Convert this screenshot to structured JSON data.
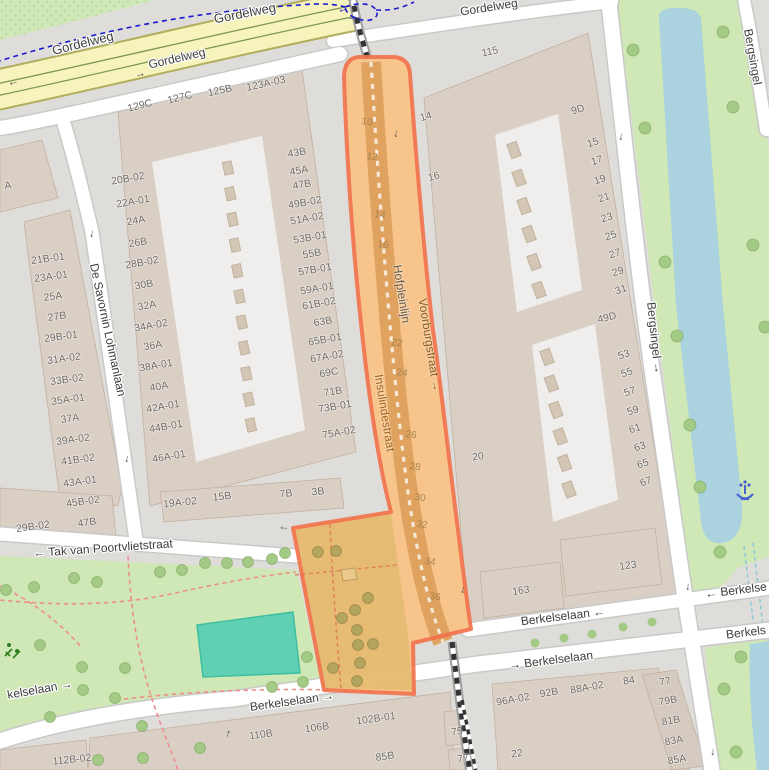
{
  "map": {
    "colors": {
      "bg": "#dfddd9",
      "park": "#cfe8b6",
      "water": "#aad3df",
      "pitch": "#5fd0b4",
      "pitch_stroke": "#3fbf9e",
      "bldg": "#d9cfc5",
      "bldg_stroke": "#c3b1a0",
      "courtyard": "#efeeec",
      "unit": "#d3c6b5",
      "unit_stroke": "#bcab96",
      "road_fill": "#ffffff",
      "road_casing": "#c9c9c9",
      "yellow": "#f6f3bc",
      "yellow_casing": "#b2ae5e",
      "tram": "#7d9a4f",
      "rail_grey": "#9e9e9e",
      "cycle": "#1a1ad0",
      "sel_fill": "#f8c288",
      "sel_stroke": "#f1714b",
      "sel_rail": "#dfa35f",
      "sel_park": "#e3bb72",
      "sel_tree": "#b2a55e",
      "sel_path": "#e07858",
      "tree": "#a4cb86",
      "path_pink": "#ef8f8f",
      "street_text": "#3d3d3d",
      "hnum": "#6f6a63",
      "rnum": "#9c7c47",
      "railname": "#6d6051",
      "selname": "#8a5c22",
      "insul": "#a2681f",
      "fountain": "#4a63d3",
      "playground": "#2f7d1f",
      "dots": "#b9d3a4"
    },
    "street_labels": [
      {
        "t": "Gordelweg",
        "x": 83,
        "y": 44,
        "r": -14,
        "cls": "big"
      },
      {
        "t": "Gordelweg",
        "x": 245,
        "y": 14,
        "r": -11,
        "cls": "big"
      },
      {
        "t": "Gordelweg",
        "x": 177,
        "y": 59,
        "r": -13
      },
      {
        "t": "Gordelweg",
        "x": 489,
        "y": 8,
        "r": -9
      },
      {
        "t": "De Savornin Lohmanlaan",
        "x": 107,
        "y": 330,
        "r": 78
      },
      {
        "t": "← Tak van Poortvlietstraat",
        "x": 103,
        "y": 549,
        "r": -4
      },
      {
        "t": "Berkelselaan ←",
        "x": 563,
        "y": 617,
        "r": -7
      },
      {
        "t": "→ Berkelselaan",
        "x": 551,
        "y": 661,
        "r": -7
      },
      {
        "t": "← Berkelse",
        "x": 736,
        "y": 591,
        "r": -7
      },
      {
        "t": "Berkels",
        "x": 746,
        "y": 633,
        "r": -7
      },
      {
        "t": "kelselaan →",
        "x": 40,
        "y": 690,
        "r": -10
      },
      {
        "t": "Berkelselaan →",
        "x": 292,
        "y": 702,
        "r": -8
      },
      {
        "t": "Bergsingel →",
        "x": 654,
        "y": 338,
        "r": 84
      },
      {
        "t": "Bergsingel",
        "x": 752,
        "y": 57,
        "r": 80
      },
      {
        "t": "Voorburgstraat →",
        "x": 429,
        "y": 345,
        "r": 81,
        "cls": "sel-name"
      },
      {
        "t": "Hofpleinlijn",
        "x": 401,
        "y": 294,
        "r": 81,
        "cls": "rail-name"
      },
      {
        "t": "Insulindestraat",
        "x": 384,
        "y": 413,
        "r": 81,
        "cls": "insul"
      }
    ],
    "house_numbers": [
      {
        "t": "A",
        "x": 8,
        "y": 186,
        "r": -8
      },
      {
        "t": "129C",
        "x": 140,
        "y": 106,
        "r": -14
      },
      {
        "t": "127C",
        "x": 180,
        "y": 98,
        "r": -14
      },
      {
        "t": "125B",
        "x": 220,
        "y": 91,
        "r": -12
      },
      {
        "t": "123A-03",
        "x": 266,
        "y": 84,
        "r": -12
      },
      {
        "t": "20B-02",
        "x": 128,
        "y": 179,
        "r": -10
      },
      {
        "t": "22A-01",
        "x": 133,
        "y": 202,
        "r": -10
      },
      {
        "t": "24A",
        "x": 136,
        "y": 221,
        "r": -10
      },
      {
        "t": "26B",
        "x": 138,
        "y": 243,
        "r": -10
      },
      {
        "t": "28B-02",
        "x": 142,
        "y": 263,
        "r": -10
      },
      {
        "t": "30B",
        "x": 144,
        "y": 285,
        "r": -10
      },
      {
        "t": "32A",
        "x": 147,
        "y": 306,
        "r": -10
      },
      {
        "t": "34A-02",
        "x": 151,
        "y": 326,
        "r": -10
      },
      {
        "t": "36A",
        "x": 153,
        "y": 346,
        "r": -10
      },
      {
        "t": "38A-01",
        "x": 156,
        "y": 366,
        "r": -10
      },
      {
        "t": "40A",
        "x": 159,
        "y": 387,
        "r": -10
      },
      {
        "t": "42A-01",
        "x": 163,
        "y": 407,
        "r": -10
      },
      {
        "t": "44B-01",
        "x": 166,
        "y": 427,
        "r": -10
      },
      {
        "t": "46A-01",
        "x": 169,
        "y": 457,
        "r": -10
      },
      {
        "t": "21B-01",
        "x": 48,
        "y": 259,
        "r": -8
      },
      {
        "t": "23A-01",
        "x": 51,
        "y": 277,
        "r": -8
      },
      {
        "t": "25A",
        "x": 53,
        "y": 297,
        "r": -8
      },
      {
        "t": "27B",
        "x": 57,
        "y": 317,
        "r": -8
      },
      {
        "t": "29B-01",
        "x": 61,
        "y": 337,
        "r": -8
      },
      {
        "t": "31A-02",
        "x": 64,
        "y": 359,
        "r": -8
      },
      {
        "t": "33B-02",
        "x": 67,
        "y": 380,
        "r": -8
      },
      {
        "t": "35A-01",
        "x": 68,
        "y": 400,
        "r": -8
      },
      {
        "t": "37A",
        "x": 70,
        "y": 419,
        "r": -8
      },
      {
        "t": "39A-02",
        "x": 73,
        "y": 440,
        "r": -8
      },
      {
        "t": "41B-02",
        "x": 78,
        "y": 460,
        "r": -8
      },
      {
        "t": "43A-01",
        "x": 80,
        "y": 482,
        "r": -8
      },
      {
        "t": "45B-02",
        "x": 83,
        "y": 502,
        "r": -8
      },
      {
        "t": "47B",
        "x": 87,
        "y": 523,
        "r": -8
      },
      {
        "t": "29B-02",
        "x": 33,
        "y": 527,
        "r": -8
      },
      {
        "t": "43B",
        "x": 297,
        "y": 153,
        "r": -10
      },
      {
        "t": "45A",
        "x": 299,
        "y": 171,
        "r": -10
      },
      {
        "t": "47B",
        "x": 302,
        "y": 185,
        "r": -10
      },
      {
        "t": "49B-02",
        "x": 305,
        "y": 203,
        "r": -10
      },
      {
        "t": "51A-02",
        "x": 307,
        "y": 219,
        "r": -10
      },
      {
        "t": "53B-01",
        "x": 310,
        "y": 238,
        "r": -10
      },
      {
        "t": "55B",
        "x": 312,
        "y": 254,
        "r": -10
      },
      {
        "t": "57B-01",
        "x": 315,
        "y": 270,
        "r": -10
      },
      {
        "t": "59A-01",
        "x": 317,
        "y": 289,
        "r": -10
      },
      {
        "t": "61B-02",
        "x": 319,
        "y": 304,
        "r": -10
      },
      {
        "t": "63B",
        "x": 323,
        "y": 322,
        "r": -10
      },
      {
        "t": "65B-01",
        "x": 325,
        "y": 340,
        "r": -10
      },
      {
        "t": "67A-02",
        "x": 327,
        "y": 357,
        "r": -10
      },
      {
        "t": "69C",
        "x": 329,
        "y": 373,
        "r": -10
      },
      {
        "t": "71B",
        "x": 333,
        "y": 392,
        "r": -10
      },
      {
        "t": "73B-01",
        "x": 335,
        "y": 407,
        "r": -10
      },
      {
        "t": "75A-02",
        "x": 339,
        "y": 433,
        "r": -10
      },
      {
        "t": "19A-02",
        "x": 180,
        "y": 503,
        "r": -6
      },
      {
        "t": "15B",
        "x": 222,
        "y": 497,
        "r": -6
      },
      {
        "t": "7B",
        "x": 286,
        "y": 494,
        "r": -6
      },
      {
        "t": "3B",
        "x": 318,
        "y": 492,
        "r": -6
      },
      {
        "t": "115",
        "x": 490,
        "y": 52,
        "r": -12
      },
      {
        "t": "14",
        "x": 426,
        "y": 117,
        "r": -16
      },
      {
        "t": "16",
        "x": 434,
        "y": 177,
        "r": -16
      },
      {
        "t": "9D",
        "x": 578,
        "y": 110,
        "r": -16
      },
      {
        "t": "15",
        "x": 593,
        "y": 143,
        "r": -18
      },
      {
        "t": "17",
        "x": 597,
        "y": 161,
        "r": -18
      },
      {
        "t": "19",
        "x": 600,
        "y": 180,
        "r": -18
      },
      {
        "t": "21",
        "x": 604,
        "y": 198,
        "r": -18
      },
      {
        "t": "23",
        "x": 607,
        "y": 218,
        "r": -18
      },
      {
        "t": "25",
        "x": 611,
        "y": 236,
        "r": -18
      },
      {
        "t": "27",
        "x": 615,
        "y": 254,
        "r": -18
      },
      {
        "t": "29",
        "x": 618,
        "y": 272,
        "r": -18
      },
      {
        "t": "31",
        "x": 621,
        "y": 290,
        "r": -18
      },
      {
        "t": "49D",
        "x": 607,
        "y": 318,
        "r": -14
      },
      {
        "t": "53",
        "x": 624,
        "y": 355,
        "r": -18
      },
      {
        "t": "55",
        "x": 627,
        "y": 373,
        "r": -18
      },
      {
        "t": "57",
        "x": 630,
        "y": 392,
        "r": -18
      },
      {
        "t": "59",
        "x": 633,
        "y": 411,
        "r": -18
      },
      {
        "t": "61",
        "x": 635,
        "y": 429,
        "r": -18
      },
      {
        "t": "63",
        "x": 640,
        "y": 447,
        "r": -18
      },
      {
        "t": "65",
        "x": 643,
        "y": 464,
        "r": -18
      },
      {
        "t": "67",
        "x": 646,
        "y": 482,
        "r": -18
      },
      {
        "t": "20",
        "x": 478,
        "y": 457,
        "r": -8
      },
      {
        "t": "163",
        "x": 521,
        "y": 591,
        "r": -8
      },
      {
        "t": "123",
        "x": 628,
        "y": 566,
        "r": -8
      },
      {
        "t": "96A-02",
        "x": 513,
        "y": 700,
        "r": -10
      },
      {
        "t": "92B",
        "x": 549,
        "y": 693,
        "r": -10
      },
      {
        "t": "88A-02",
        "x": 587,
        "y": 688,
        "r": -10
      },
      {
        "t": "84",
        "x": 629,
        "y": 681,
        "r": -10
      },
      {
        "t": "77",
        "x": 665,
        "y": 682,
        "r": -10
      },
      {
        "t": "79B",
        "x": 668,
        "y": 701,
        "r": -10
      },
      {
        "t": "81B",
        "x": 671,
        "y": 721,
        "r": -10
      },
      {
        "t": "83A",
        "x": 674,
        "y": 741,
        "r": -10
      },
      {
        "t": "85A",
        "x": 677,
        "y": 760,
        "r": -10
      },
      {
        "t": "75",
        "x": 457,
        "y": 732,
        "r": -8
      },
      {
        "t": "77",
        "x": 463,
        "y": 759,
        "r": -8
      },
      {
        "t": "22",
        "x": 517,
        "y": 754,
        "r": -8
      },
      {
        "t": "102B-01",
        "x": 376,
        "y": 719,
        "r": -8
      },
      {
        "t": "106B",
        "x": 317,
        "y": 728,
        "r": -8
      },
      {
        "t": "110B",
        "x": 261,
        "y": 735,
        "r": -8
      },
      {
        "t": "85B",
        "x": 385,
        "y": 757,
        "r": -8
      },
      {
        "t": "112B-02",
        "x": 72,
        "y": 760,
        "r": -6
      }
    ],
    "rail_numbers": [
      {
        "t": "10",
        "x": 367,
        "y": 122
      },
      {
        "t": "12",
        "x": 372,
        "y": 157
      },
      {
        "t": "14",
        "x": 380,
        "y": 215
      },
      {
        "t": "16",
        "x": 383,
        "y": 245
      },
      {
        "t": "22",
        "x": 397,
        "y": 343
      },
      {
        "t": "24",
        "x": 402,
        "y": 373
      },
      {
        "t": "26",
        "x": 411,
        "y": 435
      },
      {
        "t": "28",
        "x": 415,
        "y": 467
      },
      {
        "t": "30",
        "x": 420,
        "y": 498
      },
      {
        "t": "32",
        "x": 422,
        "y": 525
      },
      {
        "t": "34",
        "x": 430,
        "y": 562
      },
      {
        "t": "36",
        "x": 435,
        "y": 597
      }
    ],
    "arrows": [
      {
        "g": "←",
        "x": 13,
        "y": 82,
        "r": -12
      },
      {
        "g": "→",
        "x": 140,
        "y": 74,
        "r": -13
      },
      {
        "g": "↓",
        "x": 92,
        "y": 234,
        "r": 10
      },
      {
        "g": "↓",
        "x": 127,
        "y": 459,
        "r": 8
      },
      {
        "g": "↓",
        "x": 396,
        "y": 134,
        "r": 7
      },
      {
        "g": "↓",
        "x": 463,
        "y": 590,
        "r": 7
      },
      {
        "g": "←",
        "x": 284,
        "y": 527,
        "r": 4
      },
      {
        "g": "↑",
        "x": 228,
        "y": 734,
        "r": 18
      },
      {
        "g": "↓",
        "x": 621,
        "y": 137,
        "r": 5
      },
      {
        "g": "↓",
        "x": 688,
        "y": 587,
        "r": 4
      },
      {
        "g": "↓",
        "x": 713,
        "y": 752,
        "r": 4
      },
      {
        "g": "←",
        "x": 343,
        "y": 9,
        "r": -15,
        "c": "blue"
      },
      {
        "g": "→",
        "x": 353,
        "y": 17,
        "r": -10,
        "c": "blue"
      }
    ],
    "trees": {
      "park": [
        [
          74,
          578
        ],
        [
          97,
          582
        ],
        [
          6,
          590
        ],
        [
          34,
          587
        ],
        [
          160,
          572
        ],
        [
          182,
          570
        ],
        [
          205,
          563
        ],
        [
          227,
          563
        ],
        [
          248,
          562
        ],
        [
          272,
          559
        ],
        [
          285,
          553
        ],
        [
          82,
          667
        ],
        [
          83,
          690
        ],
        [
          115,
          698
        ],
        [
          125,
          668
        ],
        [
          50,
          717
        ],
        [
          143,
          758
        ],
        [
          200,
          748
        ],
        [
          272,
          687
        ],
        [
          303,
          682
        ],
        [
          307,
          657
        ],
        [
          40,
          645
        ],
        [
          142,
          726
        ],
        [
          98,
          760
        ]
      ],
      "canal": [
        [
          633,
          50
        ],
        [
          723,
          32
        ],
        [
          645,
          128
        ],
        [
          733,
          107
        ],
        [
          665,
          262
        ],
        [
          677,
          336
        ],
        [
          690,
          425
        ],
        [
          700,
          487
        ],
        [
          720,
          552
        ],
        [
          753,
          245
        ],
        [
          765,
          327
        ],
        [
          741,
          657
        ],
        [
          724,
          689
        ],
        [
          736,
          752
        ]
      ],
      "median": [
        [
          535,
          643
        ],
        [
          564,
          638
        ],
        [
          592,
          634
        ],
        [
          623,
          627
        ],
        [
          652,
          622
        ]
      ],
      "selection": [
        [
          318,
          552
        ],
        [
          336,
          551
        ],
        [
          368,
          598
        ],
        [
          355,
          610
        ],
        [
          342,
          618
        ],
        [
          357,
          630
        ],
        [
          358,
          645
        ],
        [
          373,
          644
        ],
        [
          360,
          663
        ],
        [
          333,
          668
        ],
        [
          357,
          681
        ]
      ]
    },
    "icons": [
      {
        "name": "fountain-icon",
        "x": 745,
        "y": 490
      },
      {
        "name": "playground-icon",
        "x": 12,
        "y": 648
      }
    ]
  }
}
